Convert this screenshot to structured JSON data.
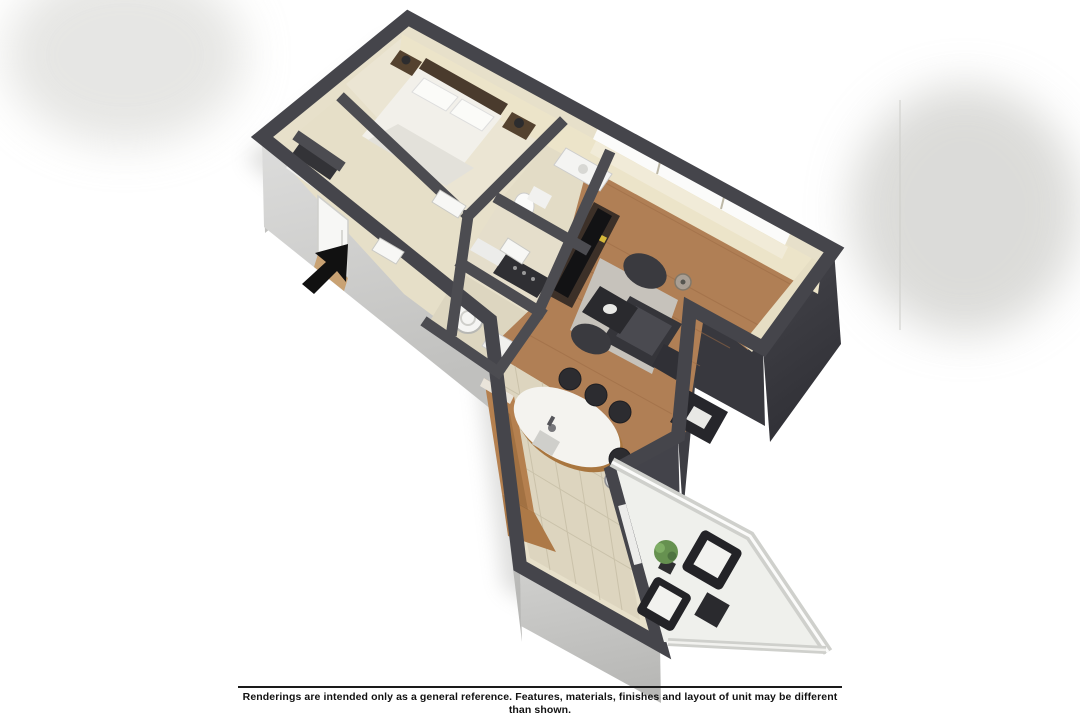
{
  "page": {
    "background": "#ffffff"
  },
  "palette": {
    "wall_top": "#45454b",
    "wall_top_interior": "#4c4c51",
    "wall_face_light": "#d4d4d2",
    "wall_face_light2": "#c6c6c4",
    "wall_face_dark": "#3a3a40",
    "interior_wall_cream": "#ece4c9",
    "floor_base": "#e7e0ca",
    "floor_carpet": "#ebe5d3",
    "floor_wood": "#b07f55",
    "floor_tile": "#ddd5bf",
    "balcony_floor": "#eff0ec",
    "counter_wood": "#b5804f",
    "dark_furniture": "#2e2e33",
    "white_surface": "#f4f3ef",
    "rug_gray": "#c7c6c1",
    "plant_green": "#669150",
    "arrow_black": "#111111"
  },
  "floor_plan": {
    "type": "3d-floorplan-rendering",
    "rooms": [
      {
        "name": "Bedroom"
      },
      {
        "name": "Closet"
      },
      {
        "name": "Bathroom"
      },
      {
        "name": "Hallway"
      },
      {
        "name": "Living Room"
      },
      {
        "name": "Dining / Kitchen"
      },
      {
        "name": "Balcony"
      }
    ],
    "entry_indicator": "arrow"
  },
  "footer": {
    "disclaimer": "Renderings are intended only as a general reference. Features, materials, finishes and layout of unit may be different than shown."
  }
}
